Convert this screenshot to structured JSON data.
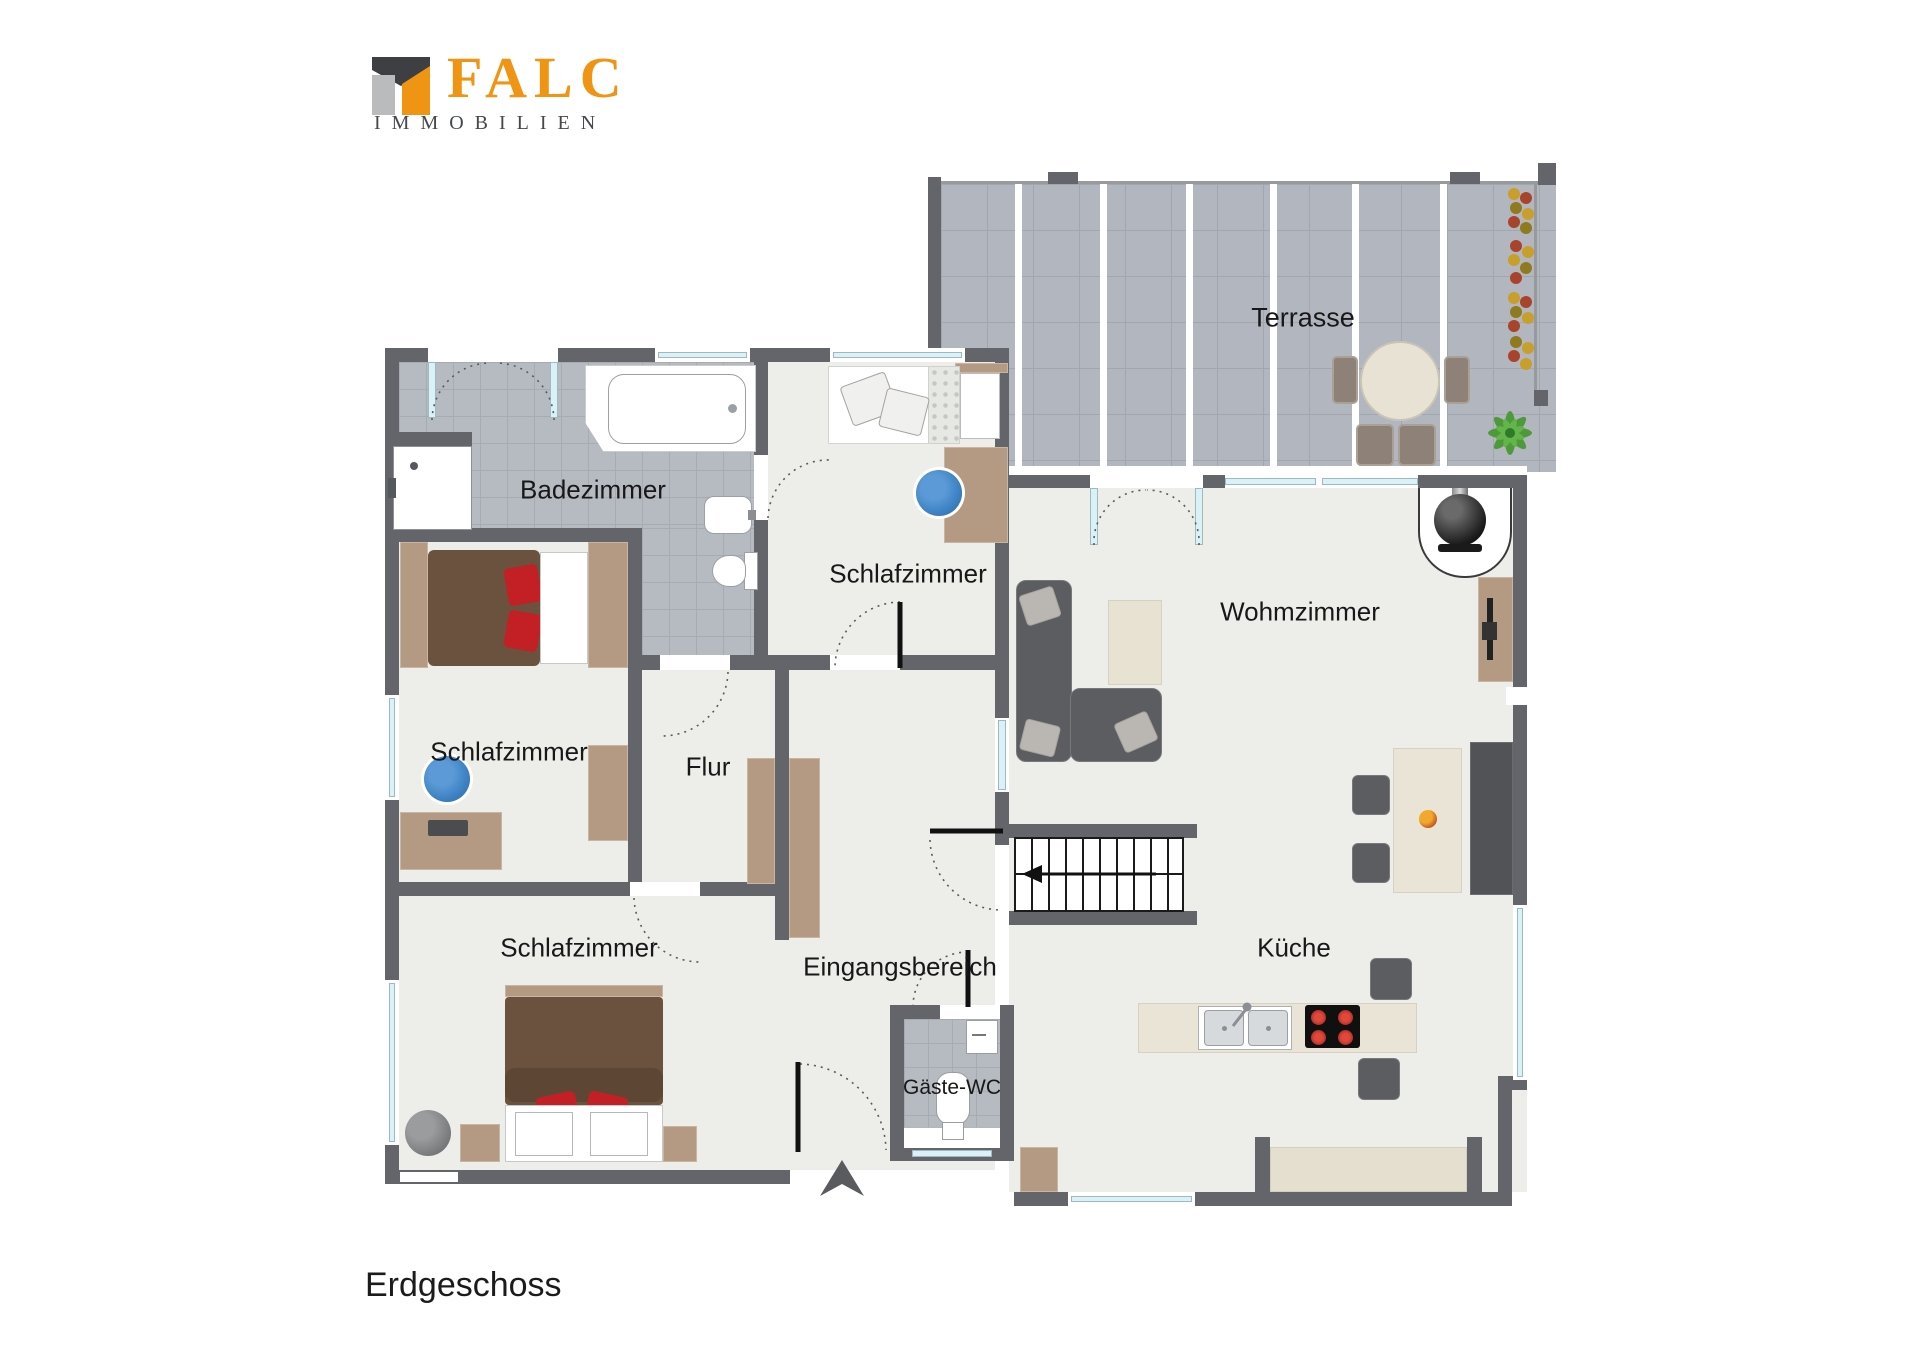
{
  "logo": {
    "brand": "FALC",
    "subtitle": "IMMOBILIEN"
  },
  "floor_label": "Erdgeschoss",
  "rooms": [
    {
      "id": "terrasse",
      "label": "Terrasse"
    },
    {
      "id": "badezimmer",
      "label": "Badezimmer"
    },
    {
      "id": "schlafzimmer-top",
      "label": "Schlafzimmer"
    },
    {
      "id": "wohnzimmer",
      "label": "Wohmzimmer"
    },
    {
      "id": "schlafzimmer-mitte",
      "label": "Schlafzimmer"
    },
    {
      "id": "flur",
      "label": "Flur"
    },
    {
      "id": "schlafzimmer-unten",
      "label": "Schlafzimmer"
    },
    {
      "id": "eingangsbereich",
      "label": "Eingangsbereich"
    },
    {
      "id": "gaeste-wc",
      "label": "Gäste-WC"
    },
    {
      "id": "kueche",
      "label": "Küche"
    }
  ],
  "colors": {
    "wall": "#63656a",
    "floor": "#edeee9",
    "tile": "#b6bbc1",
    "terrace": "#b2b6be",
    "window": "#d9f1f7",
    "wood": "#b49a82",
    "dark": "#5b5d61",
    "red": "#c32026",
    "blue": "#3f84c6",
    "orange": "#ef9413"
  }
}
